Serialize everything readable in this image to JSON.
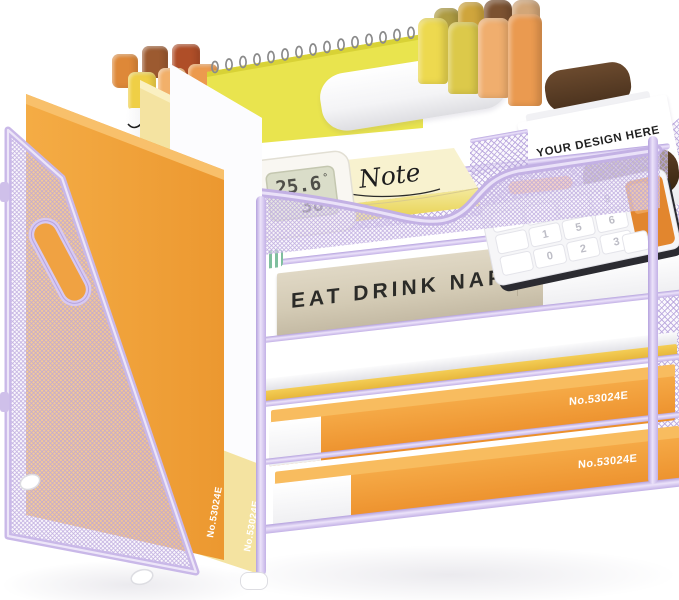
{
  "scene": {
    "type": "desk-organizer-product-photo",
    "background": "#ffffff",
    "frame_color": "#CBBAE8",
    "mesh_color": "#B7A4DC",
    "orange": "#F09A3A",
    "yellow_folder": "#F4E3A1",
    "book_color": "#DAD2BE"
  },
  "magazine_file": {
    "orange_binder_label": "No.53024E",
    "yellow_binder_label": "No.53024E"
  },
  "top_caddy": {
    "business_card_text": "YOUR DESIGN HERE"
  },
  "note_tray": {
    "sticky_note_text": "Note",
    "thermometer": {
      "temperature": "25.6",
      "temperature_unit": "°",
      "humidity": "38",
      "humidity_unit": "%"
    }
  },
  "shelf_stack": {
    "book_title": "EAT DRINK NAP",
    "upper_folder_label": "No.53024E",
    "lower_folder_label": "No.53024E",
    "calculator_keys": [
      "9",
      "6",
      "3",
      "5",
      "2",
      "0",
      "1"
    ]
  }
}
